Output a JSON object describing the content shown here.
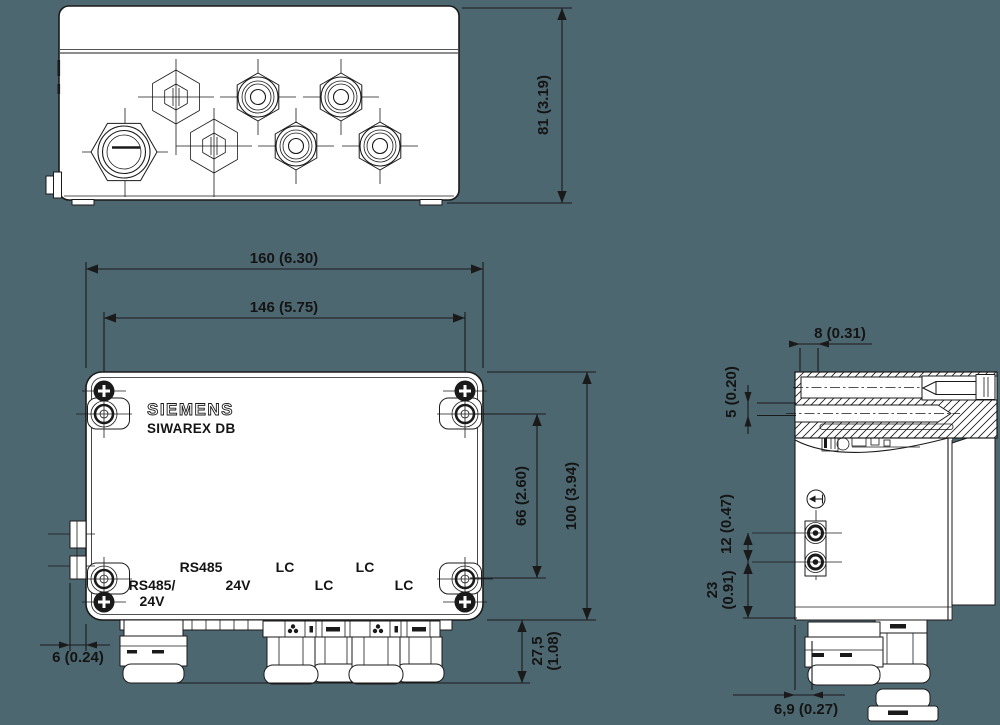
{
  "colors": {
    "background": "#4d6770",
    "line": "#1a1a1a",
    "fill": "#ffffff"
  },
  "front_view": {
    "brand": "SIEMENS",
    "product": "SIWAREX DB",
    "port_labels": [
      "RS485/",
      "24V",
      "RS485",
      "24V",
      "LC",
      "LC",
      "LC",
      "LC"
    ]
  },
  "dimensions": {
    "top_height": "81 (3.19)",
    "width_outer": "160 (6.30)",
    "width_mounting": "146 (5.75)",
    "height_outer": "100 (3.94)",
    "height_mounting": "66 (2.60)",
    "gland_depth_line1": "27,5",
    "gland_depth_line2": "(1.08)",
    "bracket_offset": "6 (0.24)",
    "side_lip": "8 (0.31)",
    "side_hole": "5 (0.20)",
    "connector_spacing": "12 (0.47)",
    "connector_offset_line1": "23",
    "connector_offset_line2": "(0.91)",
    "side_gland_offset": "6,9 (0.27)"
  }
}
